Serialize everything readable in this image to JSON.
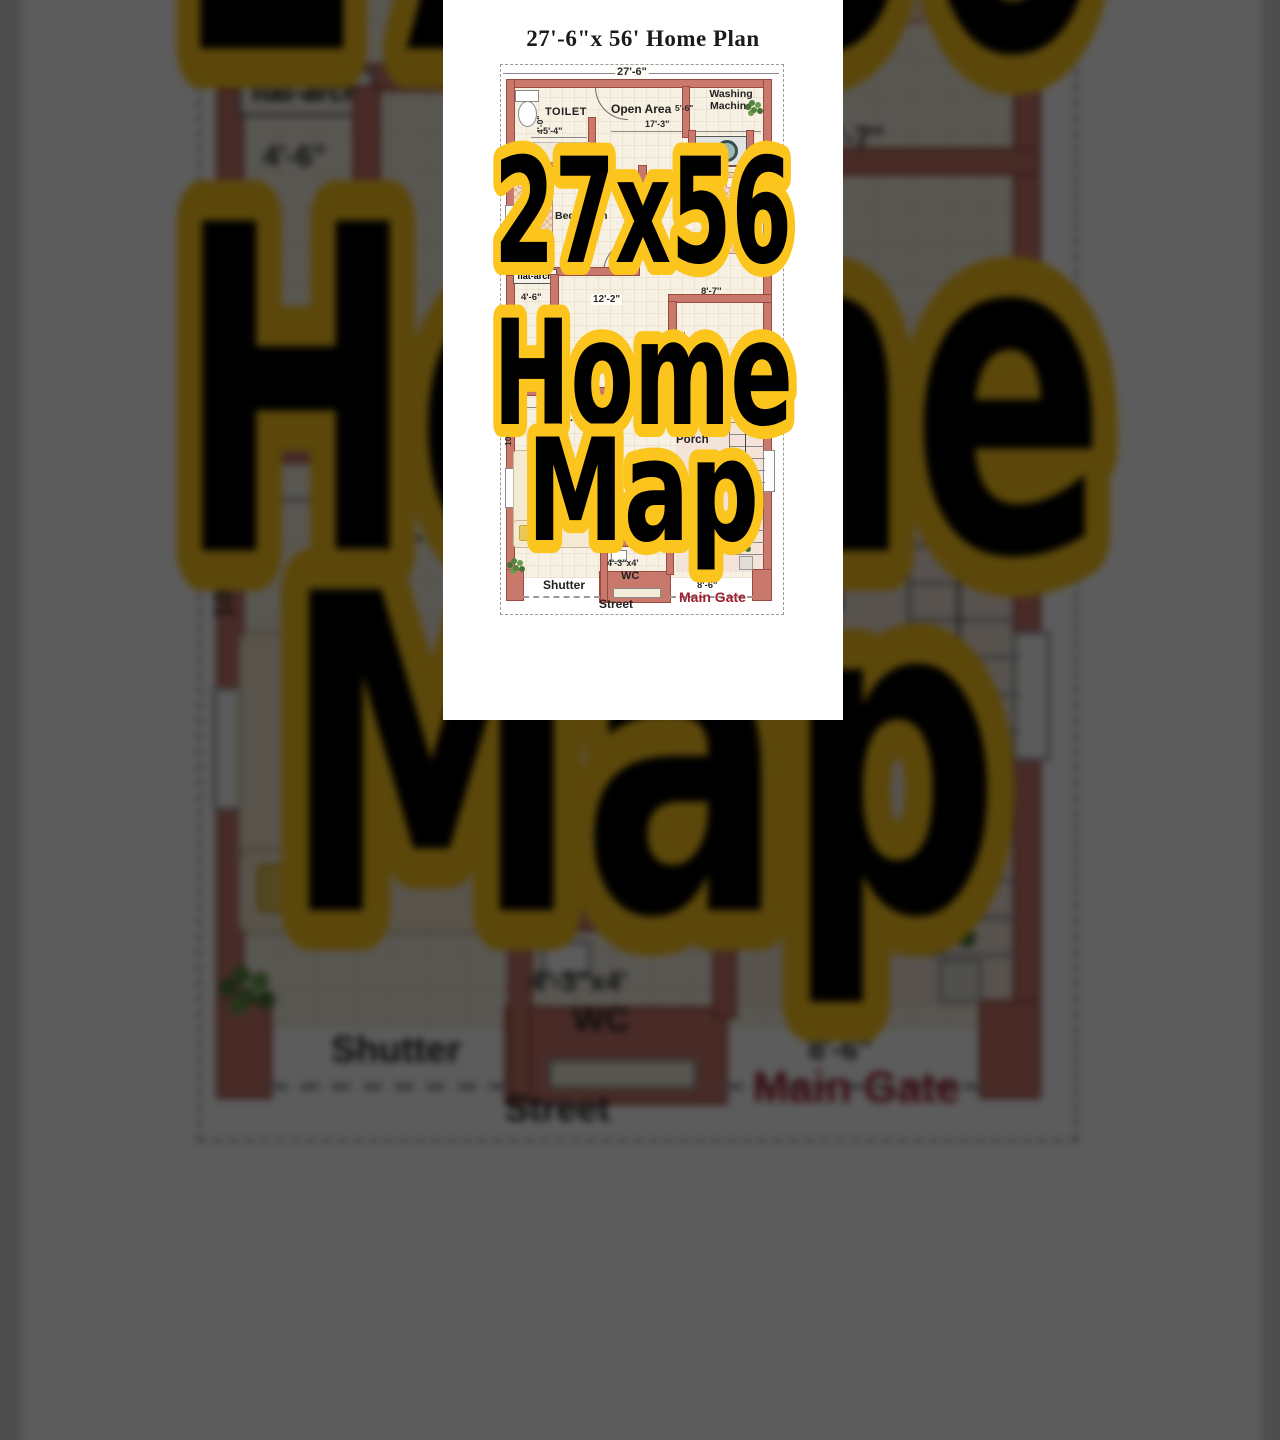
{
  "overlay": {
    "line1": "27x56",
    "line2": "Home",
    "line3": "Map"
  },
  "title": "27'-6\"x 56' Home Plan",
  "dimensions": {
    "total_width": "27'-6\"",
    "toilet_width": "5'-4\"",
    "toilet_depth": "4'-0\"",
    "open_area_width": "17'-3\"",
    "washing_width": "5'-6\"",
    "left_room": "4'-6\"",
    "lobby_width": "12'-2\"",
    "right_room": "8'-7''",
    "drg_width": "12'-3\"",
    "porch_width": "13'",
    "drg_side": "10\"",
    "drg_size": "10x10",
    "bath_size": "4'-3\"x5'-6\"",
    "wc_size": "4'-3\"x4'",
    "gate_width": "8'-6\""
  },
  "labels": {
    "toilet": "TOILET",
    "open_area": "Open Area",
    "washing_machine": "Washing Machine",
    "bed_room_left": "Bed Room",
    "bed_room_right": "Bed Room",
    "flat_arch": "flat-arch",
    "cb": "cb",
    "up": "UP",
    "drg_room": "Drg. Room",
    "porch": "Porch",
    "wc": "WC",
    "shutter": "Shutter",
    "street": "Street",
    "main_gate": "Main Gate"
  },
  "colors": {
    "wall": "#c9786c",
    "wall_border": "#9c4a40",
    "floor": "#f7f1e3",
    "overlay_yellow": "#fcc51d",
    "overlay_text": "#000000",
    "main_gate_red": "#9e1f2d",
    "backdrop_gray": "#4e4e4e"
  }
}
